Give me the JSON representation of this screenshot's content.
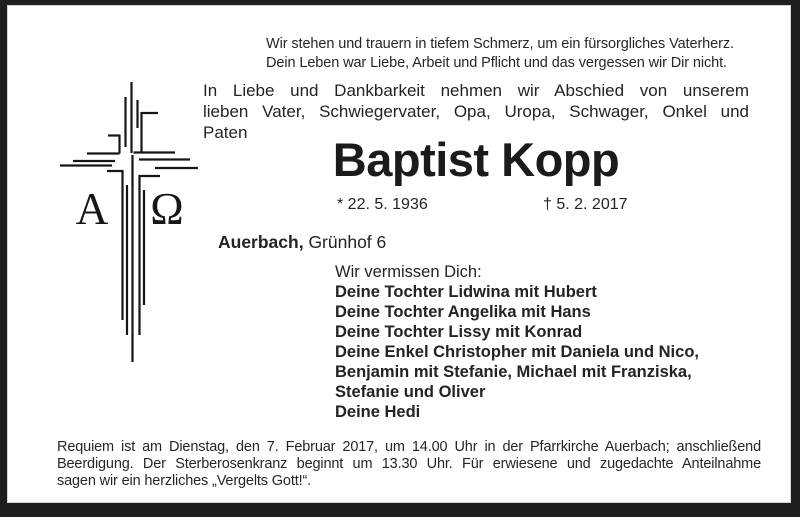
{
  "notice": {
    "verse": {
      "lines": [
        "Wir stehen und trauern in tiefem Schmerz, um ein fürsorgliches Vaterherz.",
        "Dein Leben war Liebe, Arbeit und Pflicht und das vergessen wir Dir nicht."
      ]
    },
    "intro": {
      "lines": [
        "In Liebe und Dankbarkeit nehmen wir Abschied von unserem",
        "lieben Vater, Schwiegervater, Opa, Uropa, Schwager, Onkel und",
        "Paten"
      ]
    },
    "deceased": {
      "name": "Baptist Kopp",
      "birth_date": "* 22. 5. 1936",
      "death_date": "† 5. 2. 2017"
    },
    "residence": {
      "city": "Auerbach,",
      "address": " Grünhof 6"
    },
    "mourners": {
      "heading": "Wir vermissen Dich:",
      "lines": [
        "Deine Tochter Lidwina mit Hubert",
        "Deine Tochter Angelika mit Hans",
        "Deine Tochter Lissy mit Konrad",
        "Deine Enkel Christopher mit Daniela und Nico,",
        "Benjamin mit Stefanie, Michael mit Franziska,",
        "Stefanie und Oliver",
        "Deine Hedi"
      ]
    },
    "funeral": {
      "lines": [
        "Requiem ist am Dienstag, den 7. Februar 2017, um 14.00 Uhr in der Pfarrkirche Auerbach; anschließend",
        "Beerdigung. Der Sterberosenkranz beginnt um 13.30 Uhr. Für erwiesene und zugedachte Anteilnahme",
        "sagen wir ein herzliches „Vergelts Gott!“."
      ]
    },
    "symbols": {
      "alpha": "A",
      "omega": "Ω",
      "cross_icon": "alpha-omega-line-cross"
    },
    "colors": {
      "ink": "#1d1d1b",
      "frame": "#221e1f",
      "paper": "#ffffff"
    }
  }
}
